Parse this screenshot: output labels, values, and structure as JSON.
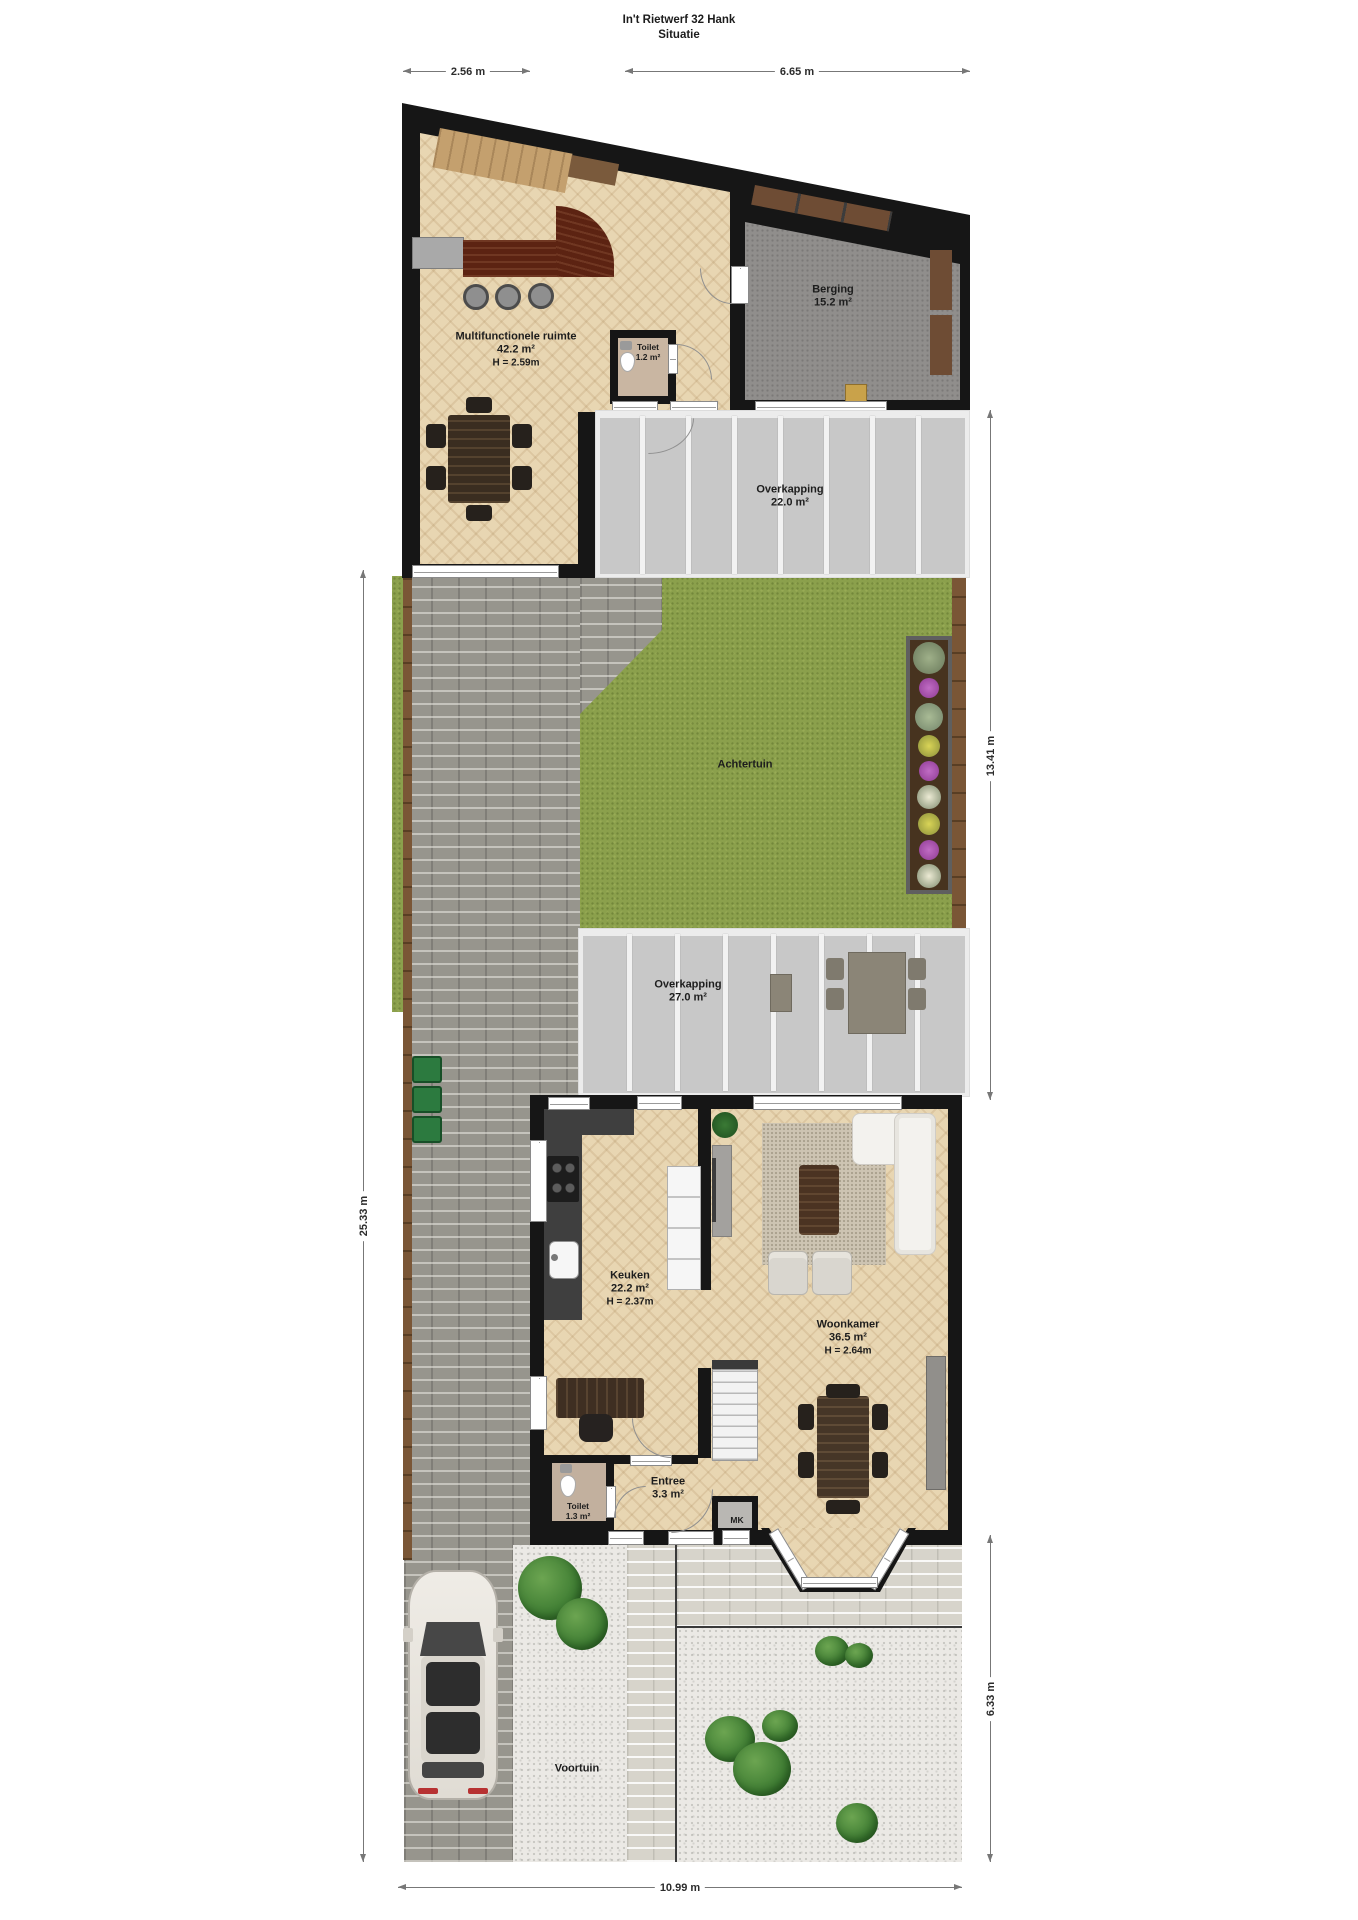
{
  "meta": {
    "title_line1": "In't Rietwerf 32 Hank",
    "title_line2": "Situatie"
  },
  "dimensions": {
    "top_left": "2.56 m",
    "top_right": "6.65 m",
    "left_side": "25.33 m",
    "right_upper": "13.41 m",
    "right_lower": "6.33 m",
    "bottom": "10.99 m"
  },
  "rooms": {
    "multifunctionele_ruimte": {
      "name": "Multifunctionele ruimte",
      "area": "42.2 m²",
      "ceiling": "H = 2.59m"
    },
    "toilet_boven": {
      "name": "Toilet",
      "area": "1.2 m²"
    },
    "berging": {
      "name": "Berging",
      "area": "15.2 m²"
    },
    "overkapping_1": {
      "name": "Overkapping",
      "area": "22.0 m²"
    },
    "achtertuin": {
      "name": "Achtertuin"
    },
    "overkapping_2": {
      "name": "Overkapping",
      "area": "27.0 m²"
    },
    "keuken": {
      "name": "Keuken",
      "area": "22.2 m²",
      "ceiling": "H = 2.37m"
    },
    "woonkamer": {
      "name": "Woonkamer",
      "area": "36.5 m²",
      "ceiling": "H = 2.64m"
    },
    "toilet_beneden": {
      "name": "Toilet",
      "area": "1.3 m²"
    },
    "entree": {
      "name": "Entree",
      "area": "3.3 m²"
    },
    "meterkast": {
      "name": "MK"
    },
    "voortuin": {
      "name": "Voortuin"
    }
  },
  "colors": {
    "wall": "#161616",
    "wood_floor": "#e8d6b2",
    "grass": "#8ba04c",
    "overkapping_floor": "#c8c8c8",
    "driveway_brick": "#97958d",
    "light_brick": "#d7d4cb",
    "gravel": "#ebe9e5",
    "bar_wood": "#5c2312",
    "fence_wood": "#7a5636"
  }
}
